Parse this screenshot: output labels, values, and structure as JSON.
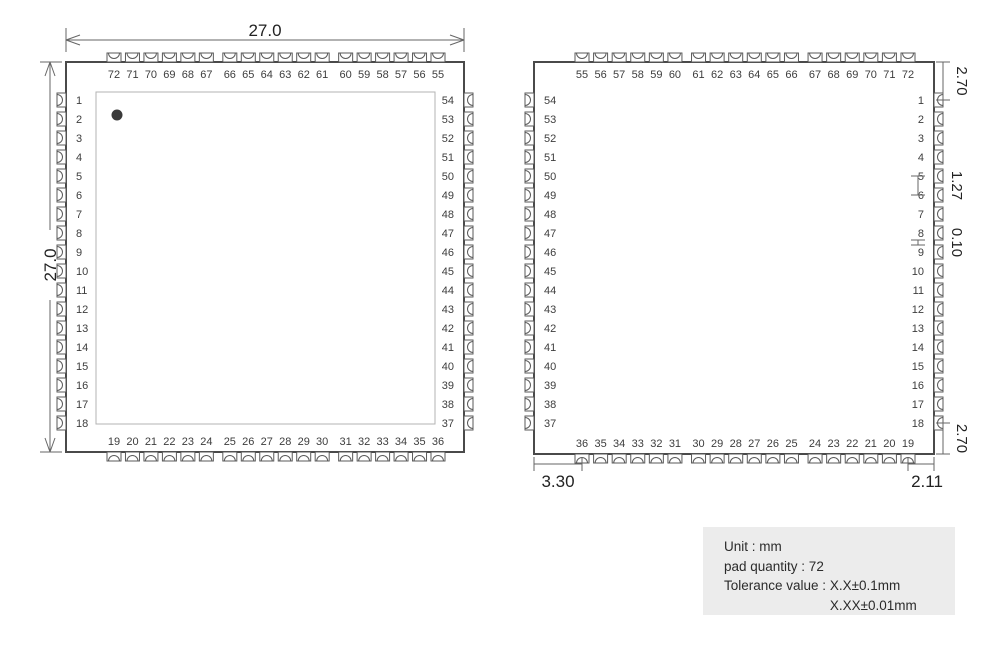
{
  "figure_colors": {
    "outline": "#4a4a4a",
    "pad_line": "#5a5a5a",
    "inner_rect": "#b3b3b3",
    "dim_line": "#666666",
    "text": "#222222",
    "note_background": "#ececec"
  },
  "views": {
    "top_view": {
      "dim_width": "27.0",
      "dim_height": "27.0",
      "pins": {
        "top": [
          72,
          71,
          70,
          69,
          68,
          67,
          66,
          65,
          64,
          63,
          62,
          61,
          60,
          59,
          58,
          57,
          56,
          55
        ],
        "left": [
          1,
          2,
          3,
          4,
          5,
          6,
          7,
          8,
          9,
          10,
          11,
          12,
          13,
          14,
          15,
          16,
          17,
          18
        ],
        "right": [
          54,
          53,
          52,
          51,
          50,
          49,
          48,
          47,
          46,
          45,
          44,
          43,
          42,
          41,
          40,
          39,
          38,
          37
        ],
        "bottom": [
          19,
          20,
          21,
          22,
          23,
          24,
          25,
          26,
          27,
          28,
          29,
          30,
          31,
          32,
          33,
          34,
          35,
          36
        ]
      }
    },
    "bottom_view": {
      "pins": {
        "top": [
          55,
          56,
          57,
          58,
          59,
          60,
          61,
          62,
          63,
          64,
          65,
          66,
          67,
          68,
          69,
          70,
          71,
          72
        ],
        "left": [
          54,
          53,
          52,
          51,
          50,
          49,
          48,
          47,
          46,
          45,
          44,
          43,
          42,
          41,
          40,
          39,
          38,
          37
        ],
        "right": [
          1,
          2,
          3,
          4,
          5,
          6,
          7,
          8,
          9,
          10,
          11,
          12,
          13,
          14,
          15,
          16,
          17,
          18
        ],
        "bottom": [
          36,
          35,
          34,
          33,
          32,
          31,
          30,
          29,
          28,
          27,
          26,
          25,
          24,
          23,
          22,
          21,
          20,
          19
        ]
      },
      "dims": {
        "edge_to_pin1": "2.70",
        "pad_pitch": "1.27",
        "pad_gap": "0.10",
        "pin18_to_edge": "2.70",
        "edge_to_pad36": "3.30",
        "pad19_to_edge": "2.11"
      }
    }
  },
  "notes": {
    "unit": "Unit : mm",
    "pad_quantity": "pad quantity : 72",
    "tolerance_label": "Tolerance value : ",
    "tolerance_values": [
      "X.X±0.1mm",
      "X.XX±0.01mm"
    ]
  }
}
